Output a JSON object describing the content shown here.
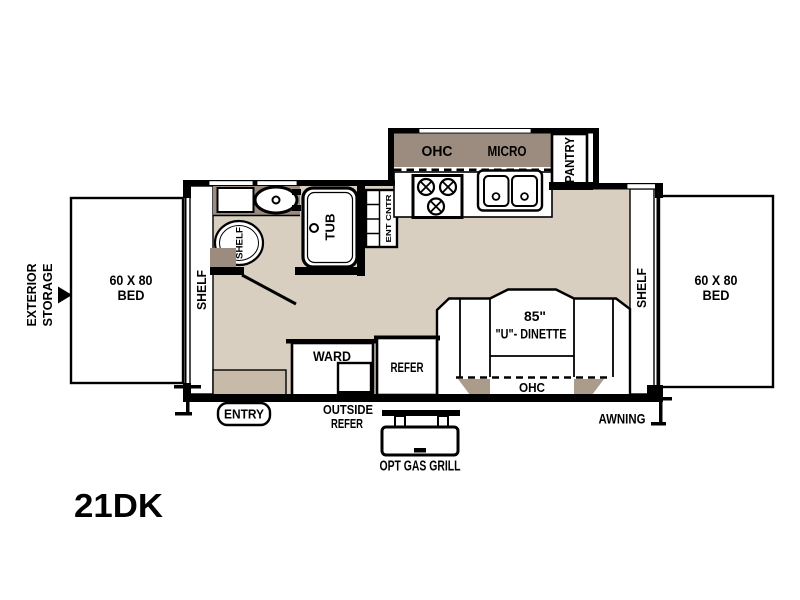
{
  "model": "21DK",
  "colors": {
    "floor": "#d9cfc1",
    "cabinet_dark": "#9b8c7f",
    "cabinet_mid": "#ab9b8b",
    "cabinet_light": "#c8baa9",
    "line": "#000000"
  },
  "bed_left": {
    "size": "60 X 80",
    "label": "BED"
  },
  "bed_right": {
    "size": "60 X 80",
    "label": "BED"
  },
  "exterior_storage": {
    "line1": "EXTERIOR",
    "line2": "STORAGE"
  },
  "shelf_left": "SHELF",
  "shelf_right": "SHELF",
  "bath": {
    "shelf": "SHELF",
    "tub": "TUB"
  },
  "ent_cabinet": "ENT CNTR",
  "kitchen": {
    "ohc": "OHC",
    "micro": "MICRO",
    "pantry": "PANTRY"
  },
  "dinette": {
    "size": "85\"",
    "name": "\"U\"- DINETTE",
    "ohc": "OHC"
  },
  "ward": "WARD",
  "refer": "REFER",
  "entry": "ENTRY",
  "outside_refer": {
    "line1": "OUTSIDE",
    "line2": "REFER"
  },
  "opt_gas_grill": "OPT GAS GRILL",
  "awning": "AWNING"
}
